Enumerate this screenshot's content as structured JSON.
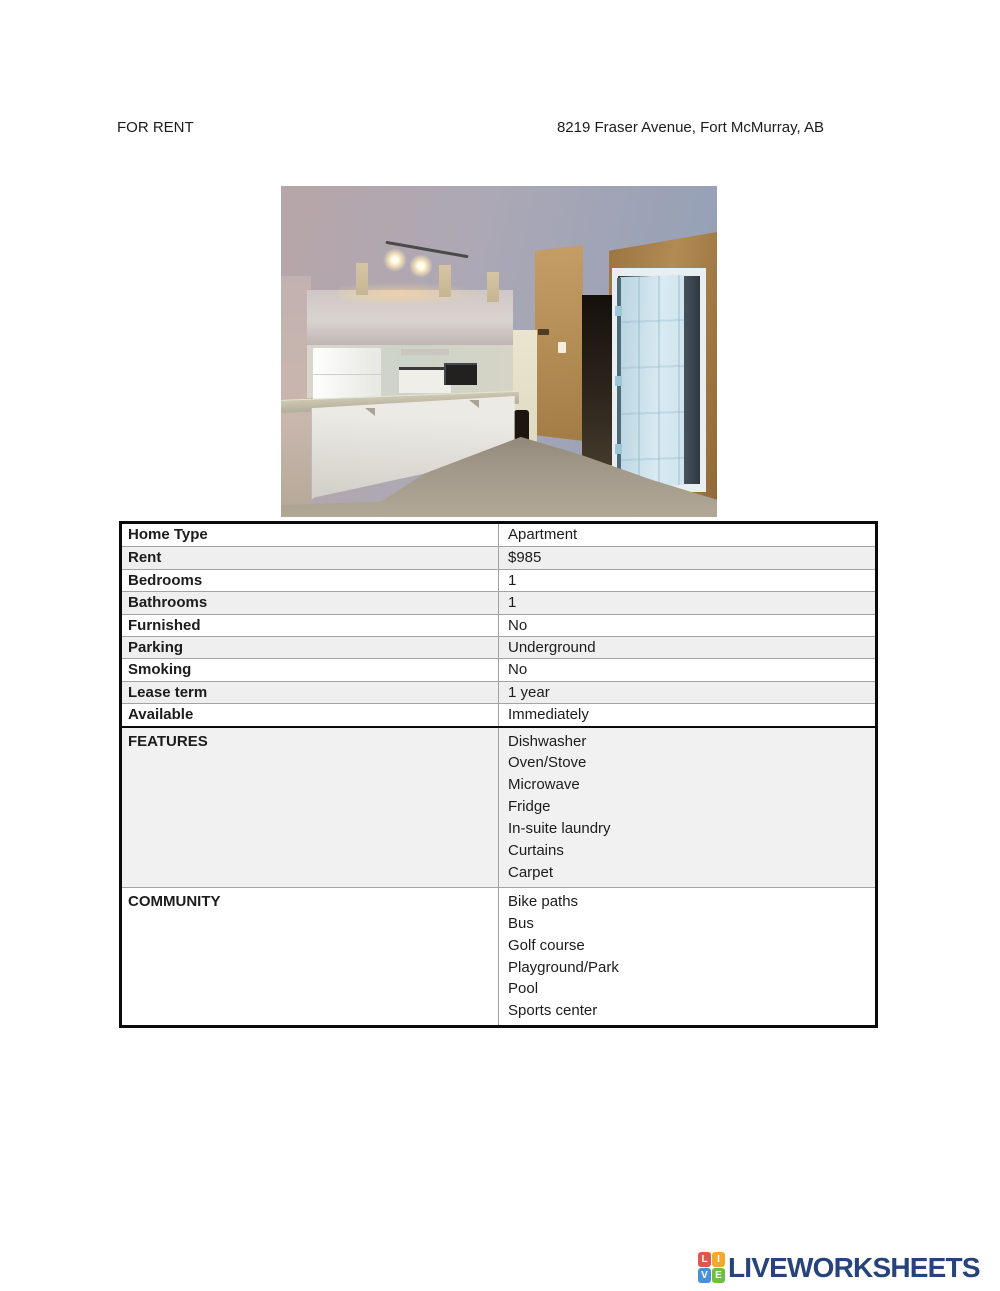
{
  "header": {
    "left": "FOR RENT",
    "right": "8219 Fraser Avenue, Fort McMurray, AB"
  },
  "photo": {
    "subject": "kitchen-and-hallway-interior"
  },
  "table": {
    "rows": [
      {
        "label": "Home Type",
        "value": "Apartment"
      },
      {
        "label": "Rent",
        "value": "$985"
      },
      {
        "label": "Bedrooms",
        "value": "1"
      },
      {
        "label": "Bathrooms",
        "value": "1"
      },
      {
        "label": "Furnished",
        "value": "No"
      },
      {
        "label": "Parking",
        "value": "Underground"
      },
      {
        "label": "Smoking",
        "value": "No"
      },
      {
        "label": "Lease term",
        "value": "1 year"
      },
      {
        "label": "Available",
        "value": "Immediately"
      }
    ],
    "sections": [
      {
        "label": "FEATURES",
        "items": [
          "Dishwasher",
          "Oven/Stove",
          "Microwave",
          "Fridge",
          "In-suite laundry",
          "Curtains",
          "Carpet"
        ]
      },
      {
        "label": "COMMUNITY",
        "items": [
          "Bike paths",
          "Bus",
          "Golf course",
          "Playground/Park",
          "Pool",
          "Sports center"
        ]
      }
    ]
  },
  "footer": {
    "logo_text": "LIVEWORKSHEETS",
    "logo_tiles": [
      {
        "letter": "L",
        "color": "#e2574c"
      },
      {
        "letter": "I",
        "color": "#f2a92e"
      },
      {
        "letter": "V",
        "color": "#4a90d9"
      },
      {
        "letter": "E",
        "color": "#6fbe44"
      }
    ],
    "logo_text_color": "#26437b"
  },
  "colors": {
    "row_stripe": "#efefef",
    "table_border": "#0a0a0a",
    "inner_border": "#a3a3a3"
  }
}
